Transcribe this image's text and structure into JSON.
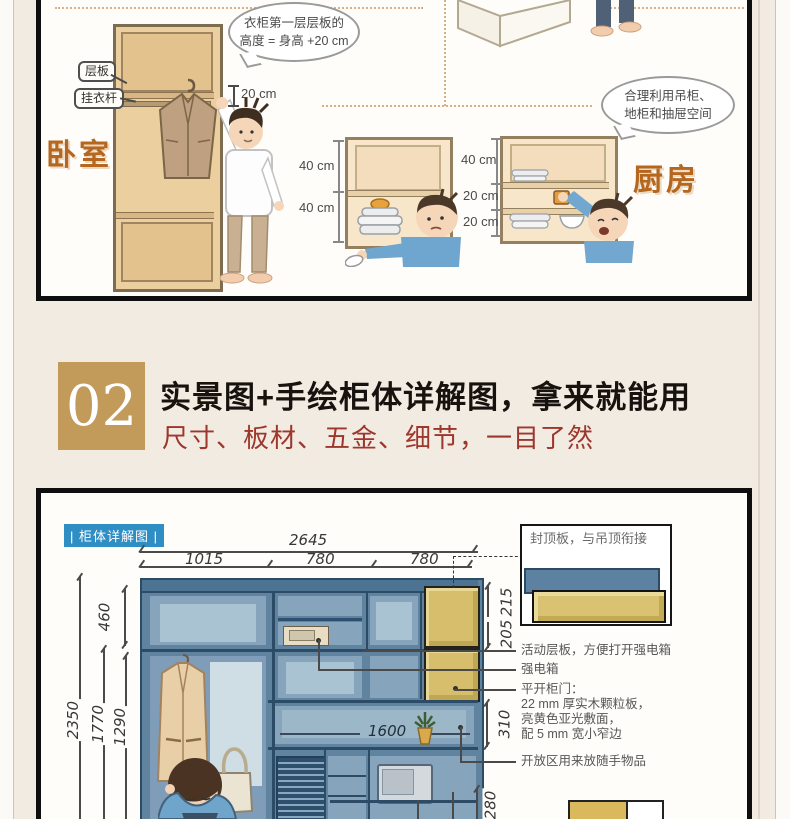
{
  "colors": {
    "page_bg": "#f2ebe2",
    "accent_gold": "#c29a59",
    "tag_blue": "#2f8ec4",
    "cabinet_blue": "#60849f",
    "door_yellow": "#d6be6d",
    "room_label_orange": "#b5671f",
    "subtitle_red": "#9d362b"
  },
  "section1": {
    "bedroom": {
      "room_label": "卧室",
      "bubble_line1": "衣柜第一层层板的",
      "bubble_line2": "高度 = 身高 +20 cm",
      "tag_shelf": "层板",
      "tag_rod": "挂衣杆",
      "gap_dim": "20 cm"
    },
    "kitchen": {
      "room_label": "厨房",
      "bubble_line1": "合理利用吊柜、",
      "bubble_line2": "地柜和抽屉空间",
      "cabinet1_dims": [
        "40 cm",
        "40 cm"
      ],
      "cabinet2_dims": [
        "40 cm",
        "20 cm",
        "20 cm"
      ]
    }
  },
  "section2": {
    "number": "02",
    "title": "实景图+手绘柜体详解图，拿来就能用",
    "subtitle": "尺寸、板材、五金、细节，一目了然"
  },
  "diagram": {
    "tag": "| 柜体详解图 |",
    "width_total": "2645",
    "width_cols": [
      "1015",
      "780",
      "780"
    ],
    "left_dims": {
      "top_section": "460",
      "full_height": "2350",
      "mid_height": "1770",
      "lower_height": "1290"
    },
    "right_dims": {
      "top": "215",
      "second": "205",
      "open_shelf": "310",
      "bottom": "280"
    },
    "shelf_width": "1600",
    "top_callout": "封顶板，与吊顶衔接",
    "annotations": [
      "活动层板，方便打开强电箱",
      "强电箱",
      "平开柜门：",
      "22 mm 厚实木颗粒板，",
      "亮黄色亚光敷面，",
      "配 5 mm 宽小窄边",
      "开放区用来放随手物品"
    ]
  }
}
